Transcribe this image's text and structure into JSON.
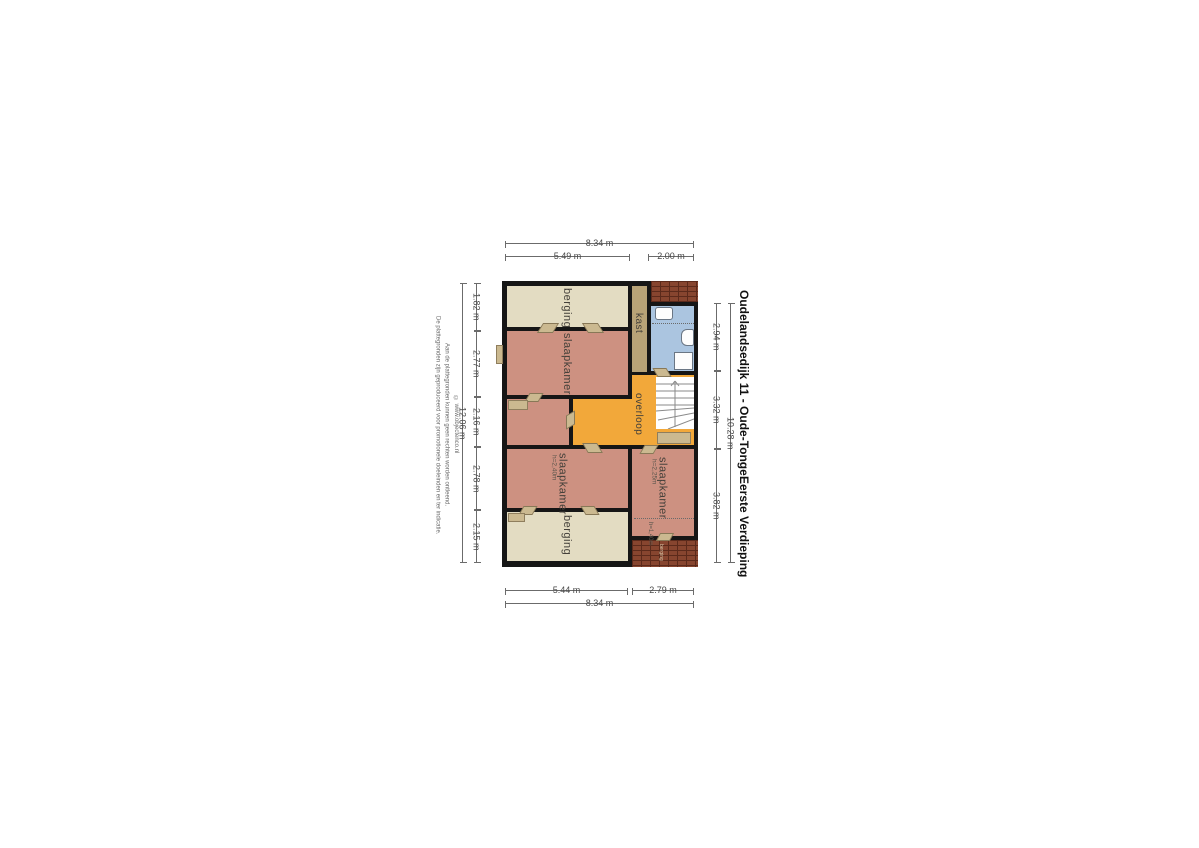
{
  "title": {
    "line1": "Oudelandsedijk 11 - Oude-Tonge",
    "line2": "Eerste Verdieping"
  },
  "disclaimer": {
    "line1": "De plattegronden zijn geproduceerd voor promotionele doeleinden en ter indicatie.",
    "line2": "Aan de plattegronden kunnen geen rechten worden ontleend.",
    "line3": "© www.objectenco.nl"
  },
  "dimensions": {
    "top": {
      "total": "8.34 m",
      "segments": [
        "5.49 m",
        "2.00 m"
      ]
    },
    "bottom": {
      "total": "8.34 m",
      "segments": [
        "5.44 m",
        "2.79 m"
      ]
    },
    "left": {
      "total": "12.06 m",
      "segments": [
        "1.82 m",
        "2.77 m",
        "2.16 m",
        "2.78 m",
        "2.15 m"
      ]
    },
    "right": {
      "total": "10.28 m",
      "segments": [
        "2.94 m",
        "3.32 m",
        "3.82 m"
      ]
    }
  },
  "rooms": {
    "berging_top": {
      "label": "berging"
    },
    "slaapkamer_1": {
      "label": "slaapkamer"
    },
    "kast": {
      "label": "kast"
    },
    "overloop": {
      "label": "overloop"
    },
    "slaapkamer_2": {
      "label": "slaapkamer",
      "height": "h=2,40m"
    },
    "slaapkamer_3": {
      "label": "slaapkamer",
      "height": "h=2,25m",
      "height2": "h=1,40m"
    },
    "berging_bottom": {
      "label": "berging"
    },
    "berging_exterior": {
      "label": "berging"
    }
  },
  "colors": {
    "wall": "#161616",
    "berging": "#e3dcc2",
    "slaapkamer": "#cd9181",
    "overloop": "#f2a83a",
    "kast": "#b8a377",
    "badkamer": "#abc5e0",
    "brick": "#87452f",
    "brick_mortar": "#5c2a1b",
    "door": "#cbb990"
  }
}
